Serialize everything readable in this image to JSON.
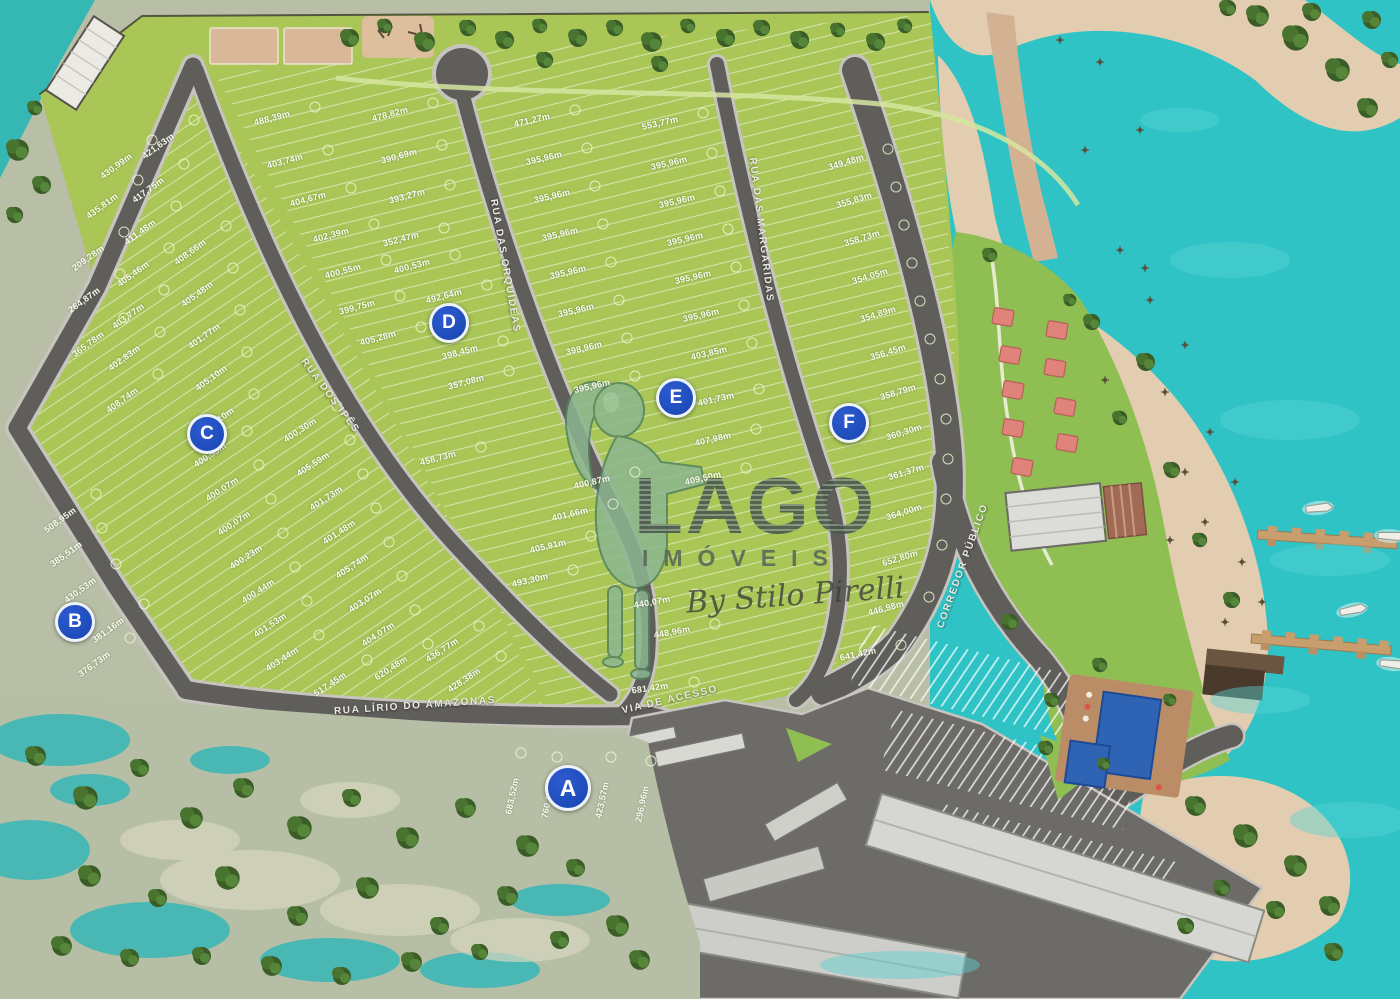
{
  "watermark": {
    "brand": "LAGO",
    "subtitle": "IMÓVEIS",
    "byline": "By Stilo Pirelli"
  },
  "sections": [
    {
      "label": "A",
      "x": 568,
      "y": 788
    },
    {
      "label": "B",
      "x": 75,
      "y": 622
    },
    {
      "label": "C",
      "x": 207,
      "y": 434
    },
    {
      "label": "D",
      "x": 449,
      "y": 323
    },
    {
      "label": "E",
      "x": 676,
      "y": 398
    },
    {
      "label": "F",
      "x": 849,
      "y": 423
    }
  ],
  "streets": [
    {
      "name": "RUA DOS IPÊS",
      "x": 330,
      "y": 396,
      "rot": 53
    },
    {
      "name": "RUA DAS ORQUÍDEAS",
      "x": 505,
      "y": 266,
      "rot": 80
    },
    {
      "name": "RUA DAS MARGARIDAS",
      "x": 761,
      "y": 230,
      "rot": 83
    },
    {
      "name": "RUA LÍRIO DO AMAZONAS",
      "x": 415,
      "y": 706,
      "rot": -4
    },
    {
      "name": "VIA DE ACESSO",
      "x": 670,
      "y": 700,
      "rot": -13
    },
    {
      "name": "CORREDOR PÚBLICO",
      "x": 963,
      "y": 566,
      "rot": -70
    }
  ],
  "lots": [
    {
      "m": "421,63m",
      "x": 158,
      "y": 146,
      "r": -36
    },
    {
      "m": "430,99m",
      "x": 116,
      "y": 166,
      "r": -36
    },
    {
      "m": "417,75m",
      "x": 148,
      "y": 190,
      "r": -36
    },
    {
      "m": "435,81m",
      "x": 102,
      "y": 206,
      "r": -36
    },
    {
      "m": "411,48m",
      "x": 140,
      "y": 232,
      "r": -36
    },
    {
      "m": "209,28m",
      "x": 88,
      "y": 258,
      "r": -36
    },
    {
      "m": "405,46m",
      "x": 133,
      "y": 274,
      "r": -36
    },
    {
      "m": "264,87m",
      "x": 84,
      "y": 300,
      "r": -36
    },
    {
      "m": "403,77m",
      "x": 128,
      "y": 316,
      "r": -36
    },
    {
      "m": "365,78m",
      "x": 88,
      "y": 344,
      "r": -36
    },
    {
      "m": "402,83m",
      "x": 124,
      "y": 358,
      "r": -36
    },
    {
      "m": "408,74m",
      "x": 122,
      "y": 400,
      "r": -36
    },
    {
      "m": "408,66m",
      "x": 190,
      "y": 252,
      "r": -36
    },
    {
      "m": "405,48m",
      "x": 197,
      "y": 294,
      "r": -36
    },
    {
      "m": "401,77m",
      "x": 204,
      "y": 336,
      "r": -36
    },
    {
      "m": "405,10m",
      "x": 211,
      "y": 378,
      "r": -36
    },
    {
      "m": "400,10m",
      "x": 218,
      "y": 420,
      "r": -36
    },
    {
      "m": "508,95m",
      "x": 60,
      "y": 520,
      "r": -36
    },
    {
      "m": "385,51m",
      "x": 66,
      "y": 554,
      "r": -36
    },
    {
      "m": "430,53m",
      "x": 80,
      "y": 590,
      "r": -36
    },
    {
      "m": "381,16m",
      "x": 108,
      "y": 630,
      "r": -36
    },
    {
      "m": "376,73m",
      "x": 94,
      "y": 664,
      "r": -36
    },
    {
      "m": "400,53m",
      "x": 210,
      "y": 455,
      "r": -33
    },
    {
      "m": "400,07m",
      "x": 222,
      "y": 489,
      "r": -33
    },
    {
      "m": "400,07m",
      "x": 234,
      "y": 523,
      "r": -33
    },
    {
      "m": "400,23m",
      "x": 246,
      "y": 557,
      "r": -33
    },
    {
      "m": "400,44m",
      "x": 258,
      "y": 591,
      "r": -33
    },
    {
      "m": "401,53m",
      "x": 270,
      "y": 625,
      "r": -33
    },
    {
      "m": "403,44m",
      "x": 282,
      "y": 659,
      "r": -33
    },
    {
      "m": "400,30m",
      "x": 300,
      "y": 430,
      "r": -33
    },
    {
      "m": "405,59m",
      "x": 313,
      "y": 464,
      "r": -33
    },
    {
      "m": "401,73m",
      "x": 326,
      "y": 498,
      "r": -33
    },
    {
      "m": "401,48m",
      "x": 339,
      "y": 532,
      "r": -33
    },
    {
      "m": "405,74m",
      "x": 352,
      "y": 566,
      "r": -33
    },
    {
      "m": "403,07m",
      "x": 365,
      "y": 600,
      "r": -33
    },
    {
      "m": "404,07m",
      "x": 378,
      "y": 634,
      "r": -33
    },
    {
      "m": "620,48m",
      "x": 391,
      "y": 668,
      "r": -33
    },
    {
      "m": "517,45m",
      "x": 330,
      "y": 684,
      "r": -33
    },
    {
      "m": "436,77m",
      "x": 442,
      "y": 650,
      "r": -33
    },
    {
      "m": "428,38m",
      "x": 464,
      "y": 680,
      "r": -33
    },
    {
      "m": "488,39m",
      "x": 272,
      "y": 118,
      "r": -15
    },
    {
      "m": "478,82m",
      "x": 390,
      "y": 114,
      "r": -15
    },
    {
      "m": "403,74m",
      "x": 285,
      "y": 161,
      "r": -15
    },
    {
      "m": "390,69m",
      "x": 399,
      "y": 156,
      "r": -15
    },
    {
      "m": "404,67m",
      "x": 308,
      "y": 199,
      "r": -15
    },
    {
      "m": "393,27m",
      "x": 407,
      "y": 196,
      "r": -15
    },
    {
      "m": "402,39m",
      "x": 331,
      "y": 235,
      "r": -15
    },
    {
      "m": "352,47m",
      "x": 401,
      "y": 239,
      "r": -15
    },
    {
      "m": "400,55m",
      "x": 343,
      "y": 271,
      "r": -15
    },
    {
      "m": "400,53m",
      "x": 412,
      "y": 266,
      "r": -15
    },
    {
      "m": "399,75m",
      "x": 357,
      "y": 307,
      "r": -15
    },
    {
      "m": "492,64m",
      "x": 444,
      "y": 296,
      "r": -15
    },
    {
      "m": "405,28m",
      "x": 378,
      "y": 338,
      "r": -15
    },
    {
      "m": "398,45m",
      "x": 460,
      "y": 352,
      "r": -15
    },
    {
      "m": "357,08m",
      "x": 466,
      "y": 382,
      "r": -15
    },
    {
      "m": "458,73m",
      "x": 438,
      "y": 458,
      "r": -15
    },
    {
      "m": "471,27m",
      "x": 532,
      "y": 120,
      "r": -13
    },
    {
      "m": "395,96m",
      "x": 544,
      "y": 158,
      "r": -13
    },
    {
      "m": "395,96m",
      "x": 552,
      "y": 196,
      "r": -13
    },
    {
      "m": "395,96m",
      "x": 560,
      "y": 234,
      "r": -13
    },
    {
      "m": "395,96m",
      "x": 568,
      "y": 272,
      "r": -13
    },
    {
      "m": "395,96m",
      "x": 576,
      "y": 310,
      "r": -13
    },
    {
      "m": "398,96m",
      "x": 584,
      "y": 348,
      "r": -13
    },
    {
      "m": "395,96m",
      "x": 592,
      "y": 386,
      "r": -13
    },
    {
      "m": "400,87m",
      "x": 592,
      "y": 482,
      "r": -13
    },
    {
      "m": "401,66m",
      "x": 570,
      "y": 514,
      "r": -13
    },
    {
      "m": "405,91m",
      "x": 548,
      "y": 546,
      "r": -13
    },
    {
      "m": "493,30m",
      "x": 530,
      "y": 580,
      "r": -13
    },
    {
      "m": "553,77m",
      "x": 660,
      "y": 123,
      "r": -13
    },
    {
      "m": "395,96m",
      "x": 669,
      "y": 163,
      "r": -13
    },
    {
      "m": "395,96m",
      "x": 677,
      "y": 201,
      "r": -13
    },
    {
      "m": "395,96m",
      "x": 685,
      "y": 239,
      "r": -13
    },
    {
      "m": "395,96m",
      "x": 693,
      "y": 277,
      "r": -13
    },
    {
      "m": "395,96m",
      "x": 701,
      "y": 315,
      "r": -13
    },
    {
      "m": "403,85m",
      "x": 709,
      "y": 353,
      "r": -13
    },
    {
      "m": "401,73m",
      "x": 716,
      "y": 399,
      "r": -13
    },
    {
      "m": "407,98m",
      "x": 713,
      "y": 439,
      "r": -13
    },
    {
      "m": "409,50m",
      "x": 703,
      "y": 478,
      "r": -13
    },
    {
      "m": "440,07m",
      "x": 652,
      "y": 602,
      "r": -10
    },
    {
      "m": "448,96m",
      "x": 672,
      "y": 632,
      "r": -10
    },
    {
      "m": "681,42m",
      "x": 650,
      "y": 688,
      "r": -8
    },
    {
      "m": "349,48m",
      "x": 846,
      "y": 162,
      "r": -17
    },
    {
      "m": "355,83m",
      "x": 854,
      "y": 200,
      "r": -17
    },
    {
      "m": "358,73m",
      "x": 862,
      "y": 238,
      "r": -17
    },
    {
      "m": "354,05m",
      "x": 870,
      "y": 276,
      "r": -17
    },
    {
      "m": "354,89m",
      "x": 878,
      "y": 314,
      "r": -17
    },
    {
      "m": "356,45m",
      "x": 888,
      "y": 352,
      "r": -17
    },
    {
      "m": "358,79m",
      "x": 898,
      "y": 392,
      "r": -17
    },
    {
      "m": "360,30m",
      "x": 904,
      "y": 432,
      "r": -17
    },
    {
      "m": "361,37m",
      "x": 906,
      "y": 472,
      "r": -17
    },
    {
      "m": "364,00m",
      "x": 904,
      "y": 512,
      "r": -17
    },
    {
      "m": "652,80m",
      "x": 900,
      "y": 558,
      "r": -17
    },
    {
      "m": "446,98m",
      "x": 886,
      "y": 608,
      "r": -15
    },
    {
      "m": "641,42m",
      "x": 858,
      "y": 654,
      "r": -12
    },
    {
      "m": "683,52m",
      "x": 512,
      "y": 796,
      "r": -78
    },
    {
      "m": "760,80m",
      "x": 548,
      "y": 800,
      "r": -78
    },
    {
      "m": "423,57m",
      "x": 602,
      "y": 800,
      "r": -78
    },
    {
      "m": "296,96m",
      "x": 642,
      "y": 804,
      "r": -78
    }
  ],
  "colors": {
    "water": "#2fc3c6",
    "sand": "#e3cdb0",
    "grass": "#a9c657",
    "amenity_grass": "#8fbe52",
    "road": "#5f5e5b",
    "road_edge": "#c7c4bd",
    "badge_blue": "#1746b0",
    "cabin_pink": "#e0837a",
    "pool_blue": "#2f64b5",
    "marsh": "#b8bfa6"
  }
}
